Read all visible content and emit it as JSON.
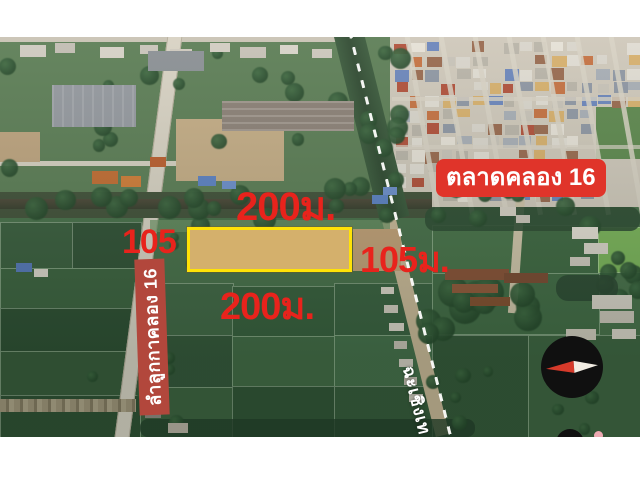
{
  "frame": {
    "background": "#ffffff"
  },
  "map": {
    "annotations": {
      "dim_top": "200ม.",
      "dim_bottom": "200ม.",
      "dim_left": "105",
      "dim_right": "105ม.",
      "dim_color": "#e8231c",
      "market_label": {
        "text": "ตลาดคลอง 16",
        "bg": "#e0342a",
        "color": "#ffffff"
      },
      "street_label": {
        "text": "ลำลูกกาคลอง 16",
        "bg": "#b2473c",
        "color": "#ffffff"
      },
      "province_label": {
        "text": "ฉะเชิงเท",
        "color": "#ffffff"
      }
    },
    "plot": {
      "outline_color": "#ffe207",
      "fill_color": "#c9a47a"
    },
    "compass": {
      "bg": "#101010",
      "needle_west": "#d63a2a",
      "needle_east": "#f2ede3"
    }
  }
}
